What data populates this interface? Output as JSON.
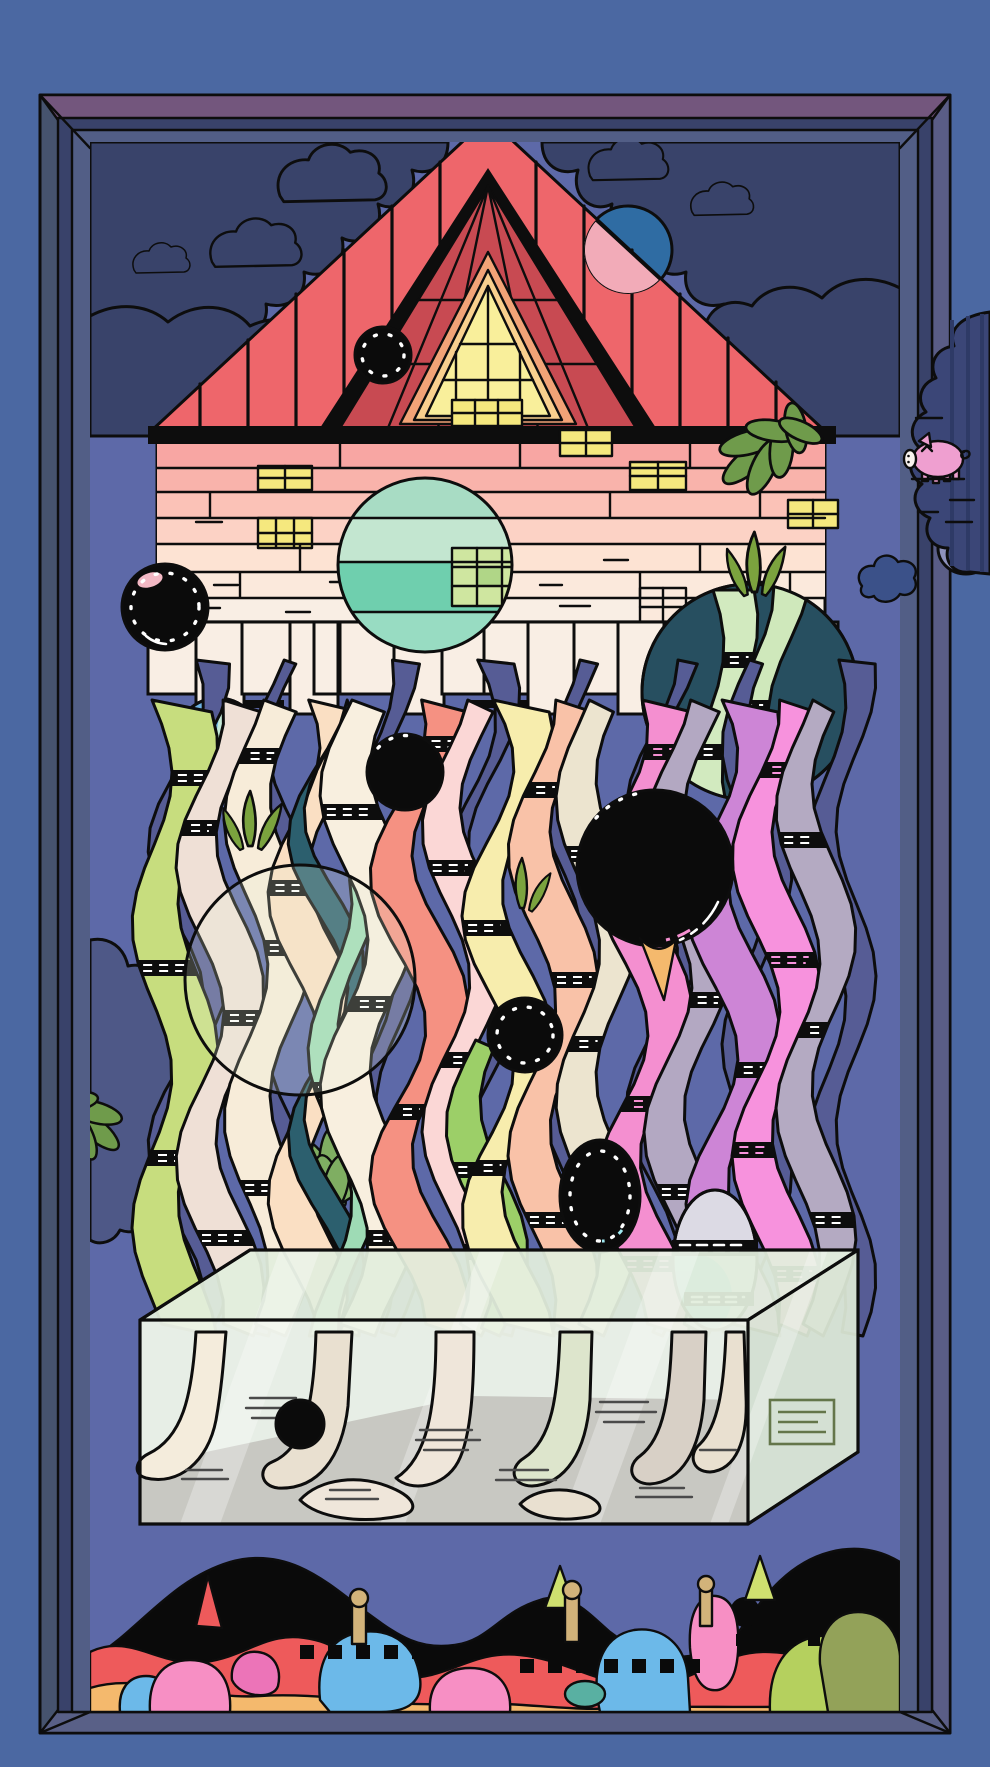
{
  "colors": {
    "outer_bg": "#4b68a2",
    "frame_side": "#46536e",
    "frame_dark": "#39426a",
    "frame_mid": "#525e86",
    "frame_top_bevel": "#73567d",
    "frame_right_bevel": "#5a5d86",
    "frame_bottom_bevel": "#596087",
    "scene_bg": "#5d69a8",
    "outline": "#0d0d0d",
    "cloud": "#39436a",
    "cloud_soft": "#4e5887",
    "cloud_out": "#8e92bd",
    "blue_blob": "#3b5189",
    "pig_cloud": "#3b4677",
    "pig_cloud_stripe": "#2e3a66",
    "pig": "#ef9fd0",
    "pig_snout": "#f9f3ef",
    "roof": "#ee666b",
    "gable": "#c84a52",
    "gable_ring": "#f2a377",
    "gable_ring2": "#f9d08e",
    "attic_window": "#f9ef9b",
    "wall1": "#f8a6a3",
    "wall2": "#f9b3ab",
    "wall3": "#fbc2b7",
    "wall4": "#fcd2c5",
    "wall5": "#fde3d3",
    "wall6": "#fbe9dc",
    "wall_cream": "#f9eee4",
    "window_yellow": "#f5e87e",
    "window_green": "#cfe6a0",
    "window_green2": "#b0d687",
    "moon_blue": "#2f6ca3",
    "moon_pink": "#f2abb8",
    "teal_c1": "#a8dcc4",
    "teal_c2": "#c3e6d0",
    "teal_c3": "#98dcc2",
    "teal_c4": "#6fcfae",
    "small_teal": "#c5ead8",
    "small_teal_blue": "#6db3e3",
    "dark_circle": "#274f60",
    "pale_oval": "#dcdae4",
    "pale_oval_teal": "#7fcbd8",
    "leaf": "#6f9b4b",
    "grass": "#7ba33e",
    "succulent": "#7fae62",
    "box_front": "#edf4e8",
    "box_top": "#e2eedd",
    "box_side": "#dce8d6",
    "box_floor": "#c8c8c2",
    "foot1": "#f4ecdc",
    "foot2": "#e9e0d0",
    "foot3": "#d8d0c6",
    "foot4": "#dde5cc",
    "foot5": "#efe6da",
    "hills": "#0a0a0a",
    "band_red": "#ee5a5b",
    "band_blue": "#6cb9e9",
    "band_orange": "#f4b96d",
    "band_pink": "#f78fc4",
    "band_magenta": "#ec74b8",
    "band_lime": "#b5d05e",
    "band_olive": "#93a259",
    "band_tan": "#d2b37a",
    "band_peak": "#cfe06f",
    "band_teal": "#59b0a2",
    "bubble": "#0b0b0b",
    "bubble_pink": "#f3b8c4",
    "shadow_strand": "#565c95"
  },
  "art": {
    "strands": {
      "shadows": [
        {
          "x": 176,
          "w": 26,
          "amp": 28,
          "ph": 0.8,
          "y0": 660,
          "y1": 1336,
          "c": "#565c95"
        },
        {
          "x": 268,
          "w": 24,
          "amp": 24,
          "ph": 2.4,
          "y0": 660,
          "y1": 1336,
          "c": "#565c95"
        },
        {
          "x": 372,
          "w": 26,
          "amp": 22,
          "ph": 1.2,
          "y0": 660,
          "y1": 1336,
          "c": "#565c95"
        },
        {
          "x": 470,
          "w": 24,
          "amp": 26,
          "ph": 0.3,
          "y0": 660,
          "y1": 1336,
          "c": "#565c95"
        },
        {
          "x": 560,
          "w": 26,
          "amp": 22,
          "ph": 2.0,
          "y0": 660,
          "y1": 1336,
          "c": "#565c95"
        },
        {
          "x": 652,
          "w": 24,
          "amp": 26,
          "ph": 1.6,
          "y0": 660,
          "y1": 1336,
          "c": "#565c95"
        },
        {
          "x": 744,
          "w": 26,
          "amp": 22,
          "ph": 2.9,
          "y0": 660,
          "y1": 1336,
          "c": "#565c95"
        },
        {
          "x": 826,
          "w": 30,
          "amp": 20,
          "ph": 0.7,
          "y0": 660,
          "y1": 1336,
          "c": "#565c95"
        }
      ],
      "circle_ribbons": [
        {
          "x": 706,
          "w": 34,
          "amp": 18,
          "ph": 0.4,
          "y0": 590,
          "y1": 806,
          "c": "#d2eabf",
          "rungs": [
            652,
            744
          ]
        },
        {
          "x": 752,
          "w": 38,
          "amp": 22,
          "ph": 1.5,
          "y0": 586,
          "y1": 806,
          "c": "#cfe8bb",
          "rungs": [
            700
          ]
        }
      ],
      "fronts": [
        {
          "x": 152,
          "w": 46,
          "amp": 20,
          "ph": 0.0,
          "y0": 700,
          "y1": 1336,
          "c": "#c7dd7e",
          "rungs": [
            770,
            960,
            1150
          ],
          "stub": 1
        },
        {
          "x": 200,
          "w": 40,
          "amp": 24,
          "ph": 1.3,
          "y0": 700,
          "y1": 1336,
          "c": "#efe0d6",
          "rungs": [
            820,
            1010,
            1230
          ],
          "stub": 1
        },
        {
          "x": 246,
          "w": 46,
          "amp": 22,
          "ph": 2.2,
          "y0": 700,
          "y1": 1336,
          "c": "#f7ecd9",
          "rungs": [
            748,
            940,
            1180
          ],
          "stub": 1
        },
        {
          "x": 294,
          "w": 40,
          "amp": 26,
          "ph": 0.6,
          "y0": 700,
          "y1": 1336,
          "c": "#fadfc3",
          "rungs": [
            880,
            1070
          ],
          "stub": 1
        },
        {
          "x": 318,
          "w": 16,
          "amp": 30,
          "ph": 1.8,
          "y0": 700,
          "y1": 1336,
          "c": "#2c5f6e",
          "rungs": [],
          "stub": 1
        },
        {
          "x": 330,
          "w": 30,
          "amp": 22,
          "ph": 1.1,
          "y0": 880,
          "y1": 1336,
          "c": "#9edbb5",
          "rungs": [
            1082
          ]
        },
        {
          "x": 344,
          "w": 50,
          "amp": 24,
          "ph": 2.8,
          "y0": 700,
          "y1": 1336,
          "c": "#f8efdf",
          "rungs": [
            804,
            996,
            1230
          ],
          "stub": 1
        },
        {
          "x": 398,
          "w": 42,
          "amp": 28,
          "ph": 1.0,
          "y0": 700,
          "y1": 1336,
          "c": "#f59182",
          "rungs": [
            736,
            1104
          ],
          "stub": 1
        },
        {
          "x": 446,
          "w": 38,
          "amp": 24,
          "ph": 2.0,
          "y0": 700,
          "y1": 1336,
          "c": "#fbd7d6",
          "rungs": [
            860,
            1052,
            1244
          ],
          "stub": 1
        },
        {
          "x": 470,
          "w": 34,
          "amp": 24,
          "ph": 2.9,
          "y0": 1040,
          "y1": 1336,
          "c": "#9ccf68",
          "rungs": [
            1162
          ]
        },
        {
          "x": 488,
          "w": 40,
          "amp": 26,
          "ph": 0.2,
          "y0": 700,
          "y1": 1336,
          "c": "#f7edad",
          "rungs": [
            920,
            1160
          ],
          "stub": 1
        },
        {
          "x": 532,
          "w": 42,
          "amp": 24,
          "ph": 1.5,
          "y0": 700,
          "y1": 1336,
          "c": "#f9c2a8",
          "rungs": [
            782,
            972,
            1212
          ],
          "stub": 1
        },
        {
          "x": 578,
          "w": 40,
          "amp": 22,
          "ph": 2.6,
          "y0": 700,
          "y1": 1336,
          "c": "#ece4cf",
          "rungs": [
            846,
            1036
          ],
          "stub": 1
        },
        {
          "x": 622,
          "w": 44,
          "amp": 26,
          "ph": 0.9,
          "y0": 700,
          "y1": 1336,
          "c": "#f48fd0",
          "rungs": [
            744,
            906,
            1096,
            1256
          ],
          "dash": "#f48fd0",
          "stub": 1
        },
        {
          "x": 668,
          "w": 40,
          "amp": 24,
          "ph": 1.9,
          "y0": 700,
          "y1": 1336,
          "c": "#b3a8c2",
          "rungs": [
            800,
            992,
            1184
          ],
          "stub": 1
        },
        {
          "x": 712,
          "w": 42,
          "amp": 26,
          "ph": 0.4,
          "y0": 700,
          "y1": 1336,
          "c": "#cd85d6",
          "rungs": [
            872,
            1062
          ],
          "stub": 1
        },
        {
          "x": 756,
          "w": 40,
          "amp": 24,
          "ph": 1.4,
          "y0": 700,
          "y1": 1336,
          "c": "#f792dd",
          "rungs": [
            762,
            952,
            1142,
            1266
          ],
          "dash": "#f792dd",
          "stub": 1
        },
        {
          "x": 798,
          "w": 36,
          "amp": 22,
          "ph": 2.4,
          "y0": 700,
          "y1": 1336,
          "c": "#b4aac2",
          "rungs": [
            832,
            1022,
            1212
          ],
          "stub": 1
        }
      ]
    }
  }
}
